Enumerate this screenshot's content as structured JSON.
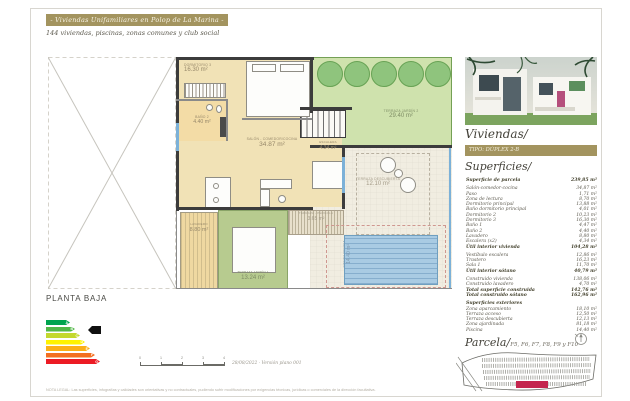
{
  "header": {
    "banner": "- Viviendas Unifamiliares en Polop de La Marina -",
    "subtitle": "144 viviendas, piscinas, zonas comunes y club social"
  },
  "plan": {
    "title": "PLANTA BAJA",
    "rooms": [
      {
        "label": "DORMITORIO 3",
        "area": "16.30 m²"
      },
      {
        "label": "BAÑO 2",
        "area": "4.40 m²"
      },
      {
        "label": "SALÓN - COMEDOR/COCINA",
        "area": "34.87 m²"
      },
      {
        "label": "ESCALERA",
        "area": "4.34 m²"
      },
      {
        "label": "TERRAZA JARDÍN 2",
        "area": "29.40 m²"
      },
      {
        "label": "TERRAZA DESCUBIERTA",
        "area": "12.10 m²"
      },
      {
        "label": "TERRAZA - PÉRGOLA",
        "area": "3.65 m²"
      },
      {
        "label": "TERRAZA JARDÍN 1",
        "area": "13.24 m²"
      },
      {
        "label": "LAVADERO",
        "area": "8.80 m²"
      },
      {
        "label": "PISCINA PRIVADA",
        "area": "14.40 m²"
      }
    ],
    "scale_ticks": [
      "0",
      "1",
      "2",
      "3",
      "4"
    ],
    "version_note": "28/08/2022 · Versión plano 001"
  },
  "energy": {
    "bars": [
      {
        "label": "A",
        "color": "#00a44f",
        "width": 24
      },
      {
        "label": "B",
        "color": "#51b747",
        "width": 29
      },
      {
        "label": "C",
        "color": "#c3d82e",
        "width": 34
      },
      {
        "label": "D",
        "color": "#fef200",
        "width": 39
      },
      {
        "label": "E",
        "color": "#fbaf17",
        "width": 44
      },
      {
        "label": "F",
        "color": "#f36f21",
        "width": 49
      },
      {
        "label": "G",
        "color": "#ec1b24",
        "width": 54
      }
    ],
    "selected": "B"
  },
  "sidebar": {
    "viviendas_title": "Viviendas/",
    "tipo_badge": "TIPO: DÚPLEX 2-B",
    "superficies_title": "Superficies/",
    "table": {
      "rows": [
        {
          "c": "Superficie de parcela",
          "v": "239,85 m²",
          "b": true,
          "gap": true
        },
        {
          "c": "Salón-comedor-cocina",
          "v": "34,87 m²"
        },
        {
          "c": "Paso",
          "v": "1,71 m²"
        },
        {
          "c": "Zona de lectura",
          "v": "8,70 m²"
        },
        {
          "c": "Dormitorio principal",
          "v": "13,88 m²"
        },
        {
          "c": "Baño dormitorio principal",
          "v": "4,01 m²"
        },
        {
          "c": "Dormitorio 2",
          "v": "10,23 m²"
        },
        {
          "c": "Dormitorio 3",
          "v": "16,30 m²"
        },
        {
          "c": "Baño 1",
          "v": "4,47 m²"
        },
        {
          "c": "Baño 2",
          "v": "4,40 m²"
        },
        {
          "c": "Lavadero",
          "v": "8,80 m²"
        },
        {
          "c": "Escalera (x2)",
          "v": "4,34 m²"
        },
        {
          "c": "Útil interior vivienda",
          "v": "104,28 m²",
          "b": true,
          "gap": true
        },
        {
          "c": "Vestíbulo escalera",
          "v": "12,86 m²"
        },
        {
          "c": "Trastero",
          "v": "16,23 m²"
        },
        {
          "c": "Sala 1",
          "v": "11,70 m²"
        },
        {
          "c": "Útil interior sótano",
          "v": "40,79 m²",
          "b": true,
          "gap": true
        },
        {
          "c": "Construido vivienda",
          "v": "138,06 m²"
        },
        {
          "c": "Construido lavadero",
          "v": "4,70 m²"
        },
        {
          "c": "Total superficie construida",
          "v": "142,76 m²",
          "b": true
        },
        {
          "c": "Total construido sótano",
          "v": "162,96 m²",
          "b": true,
          "gap": true
        },
        {
          "c": "Superficies exteriores",
          "v": "",
          "b": true
        },
        {
          "c": "Zona aparcamiento",
          "v": "18,10 m²"
        },
        {
          "c": "Terraza acceso",
          "v": "12,50 m²"
        },
        {
          "c": "Terraza descubierta",
          "v": "12,13 m²"
        },
        {
          "c": "Zona ajardinada",
          "v": "81,18 m²"
        },
        {
          "c": "Piscina",
          "v": "14,40 m²"
        }
      ]
    },
    "parcela_title": "Parcela/",
    "parcela_lots": "F5, F6, F7, F8, F9 y F10"
  },
  "footer": {
    "legal": "NOTA LEGAL: Las superficies, infografías y calidades son orientativas y no contractuales, pudiendo sufrir modificaciones por exigencias técnicas, jurídicas o comerciales de la dirección facultativa."
  },
  "colors": {
    "accent_gold": "#a3945f",
    "parcel_red": "#c4254e",
    "pool_blue": "#a9cbe3"
  }
}
